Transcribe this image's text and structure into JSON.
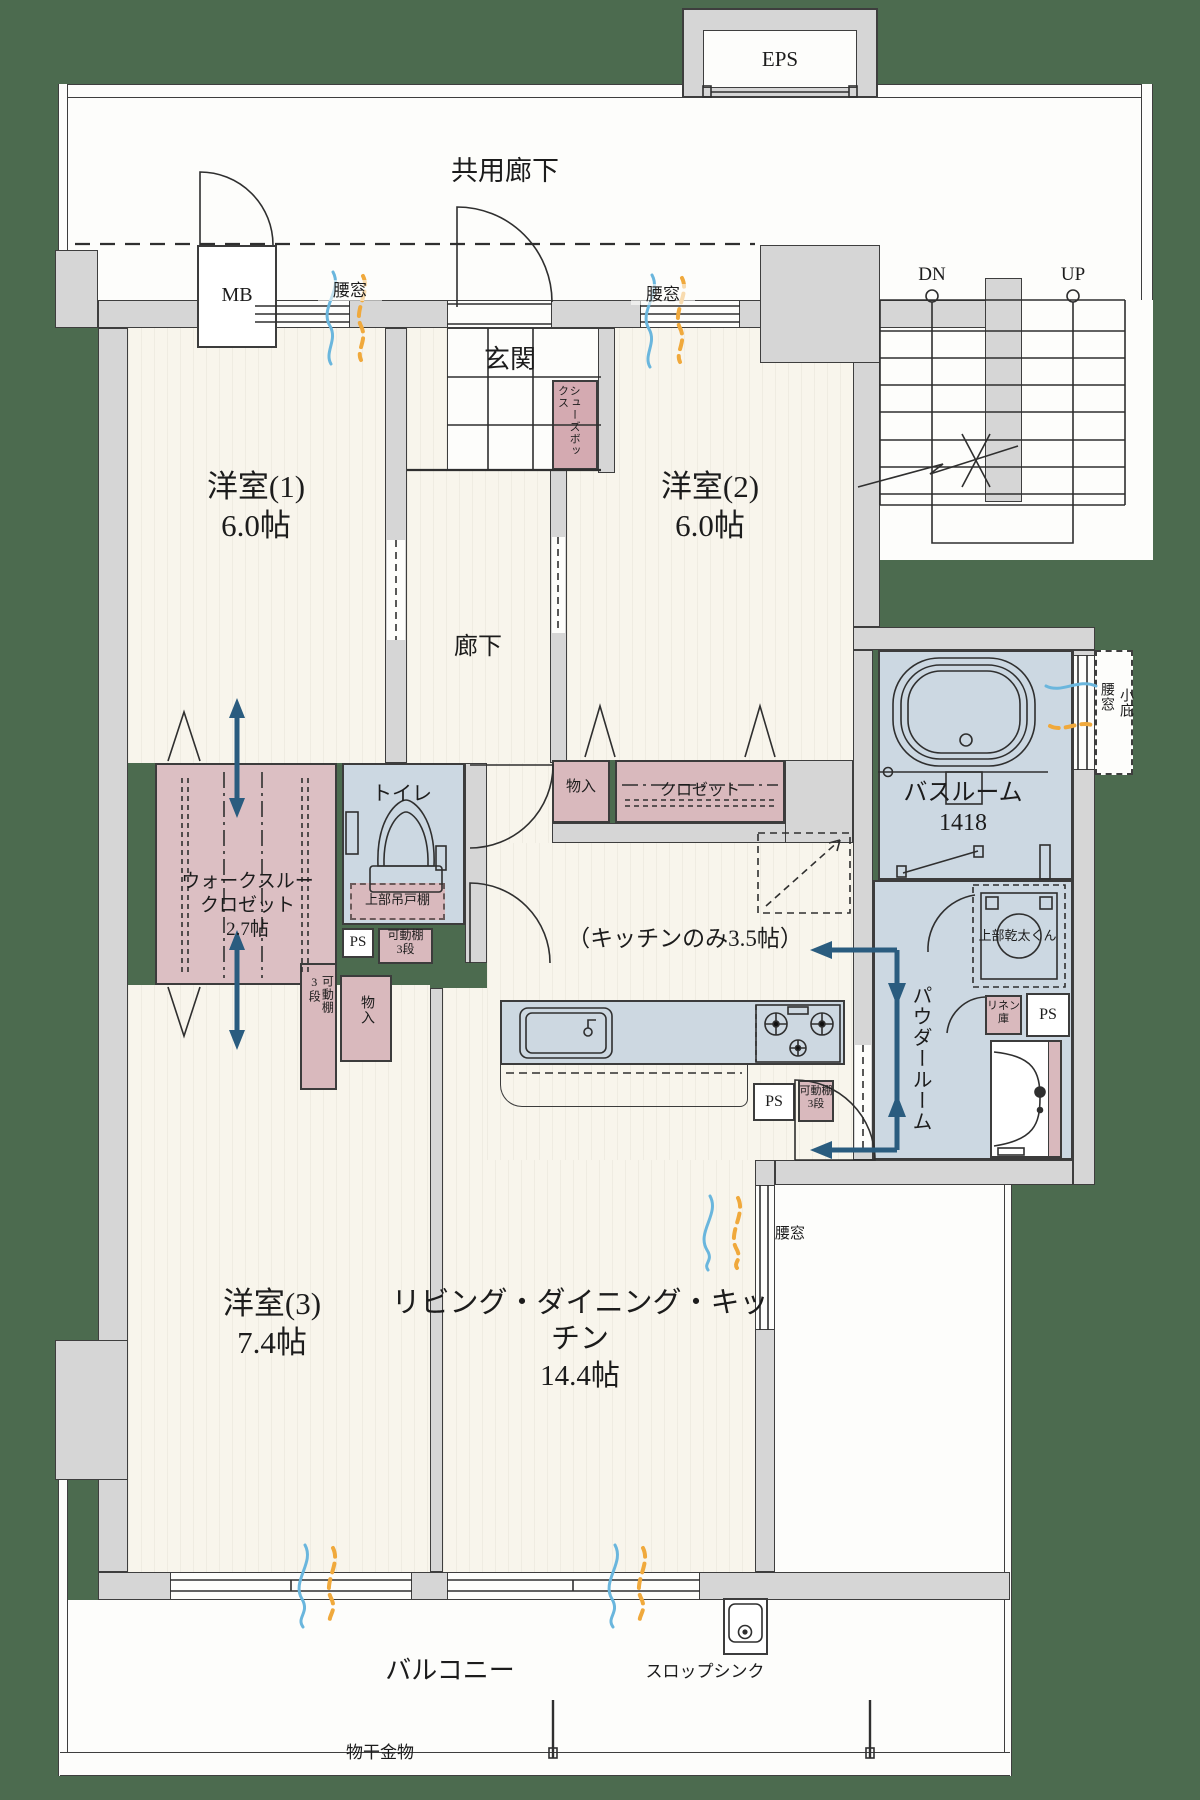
{
  "colors": {
    "background_green": "#4c6b4f",
    "wall_gray": "#d6d6d6",
    "floor_cream": "#f8f5ec",
    "wet_blue": "#ccd8e2",
    "storage_pink": "#d9b9bd",
    "arrow_blue": "#2a5c7f",
    "wind_blue": "#6ab6dd",
    "wind_orange": "#f0a93c"
  },
  "labels": {
    "eps": "EPS",
    "common_corridor": "共用廊下",
    "mb": "MB",
    "dn": "DN",
    "up": "UP",
    "entrance": "玄関",
    "shoe_box": "シューズボックス",
    "window_waist": "腰窓",
    "small_eaves": "小庇",
    "room1": "洋室(1)\n6.0帖",
    "room2": "洋室(2)\n6.0帖",
    "room3": "洋室(3)\n7.4帖",
    "hallway": "廊下",
    "ldk": "リビング・ダイニング・キッチン\n14.4帖",
    "kitchen_note": "（キッチンのみ3.5帖）",
    "walk_through_closet": "ウォークスルー\nクロゼット\n2.7帖",
    "bathroom": "バスルーム\n1418",
    "toilet": "トイレ",
    "upper_cabinet": "上部吊戸棚",
    "ps": "PS",
    "movable_shelf": "可動棚\n3段",
    "storage_closet_small": "物入",
    "closet": "クロゼット",
    "gas_dryer": "上部乾太くん",
    "linen": "リネン\n庫",
    "powder_room": "パウダールーム",
    "balcony": "バルコニー",
    "slop_sink": "スロップシンク",
    "laundry_hardware": "物干金物"
  }
}
